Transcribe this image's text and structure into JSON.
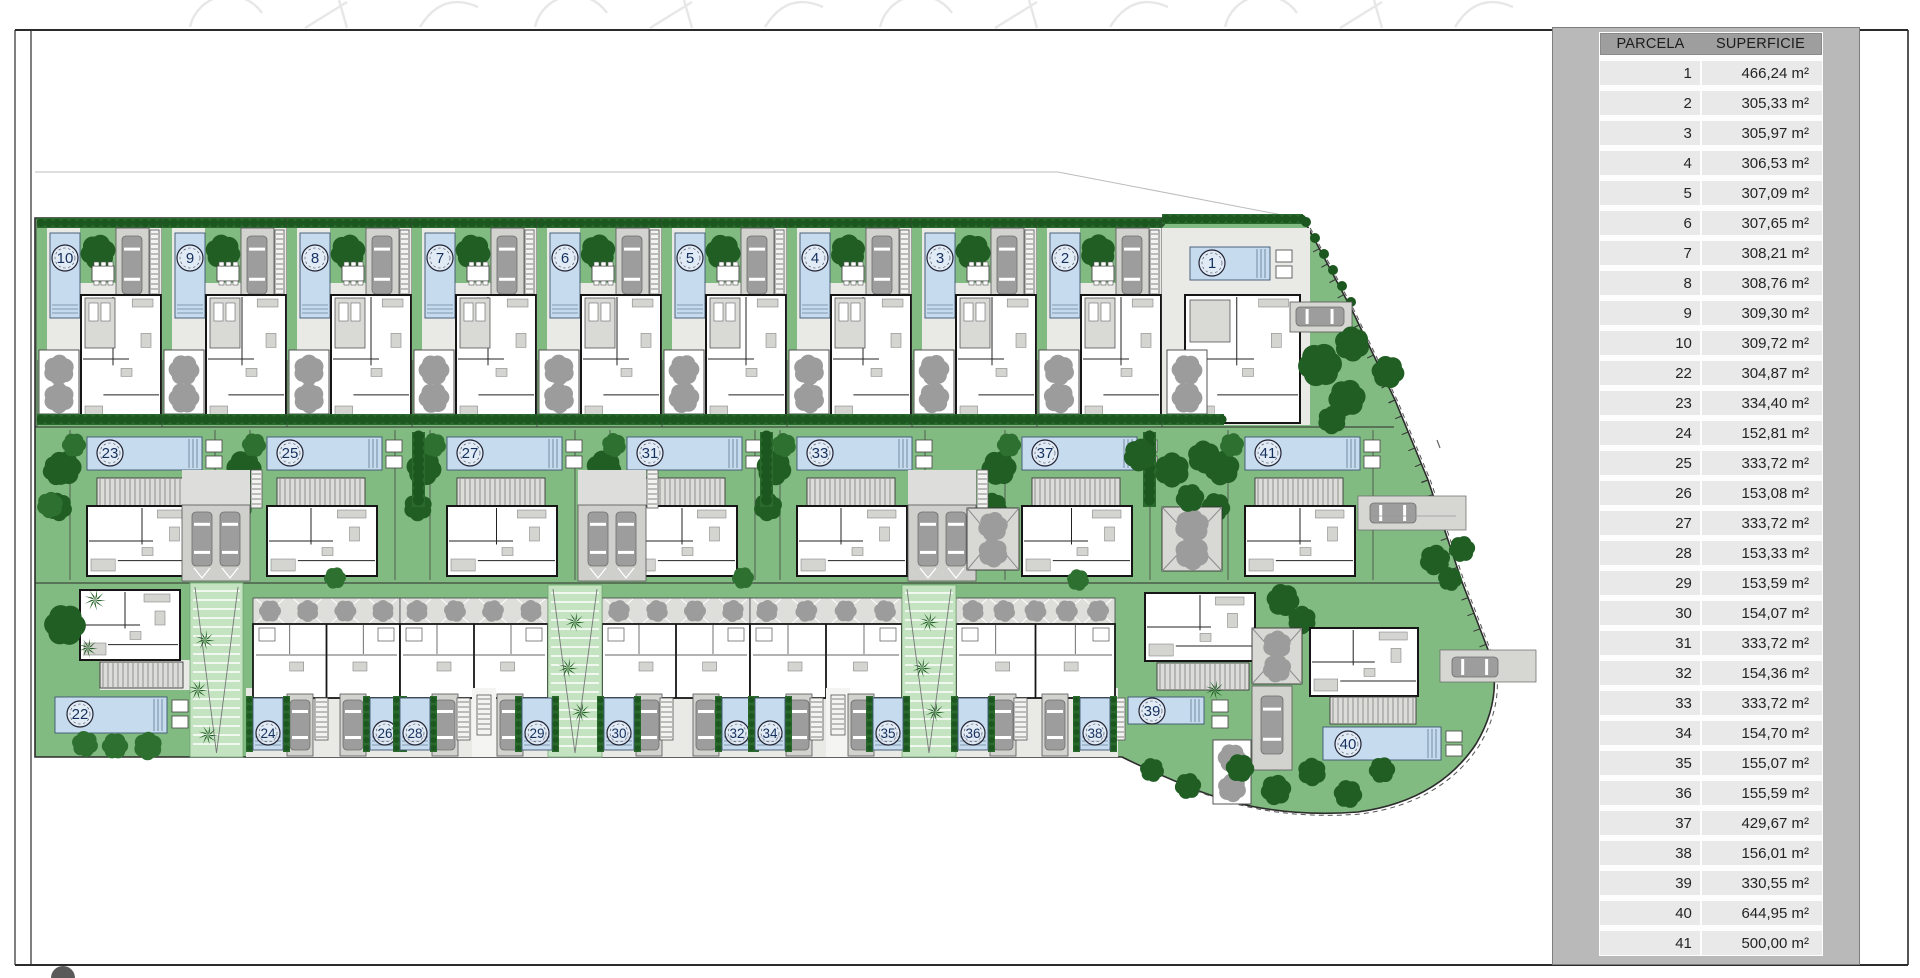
{
  "panel": {
    "col1": "PARCELA",
    "col2": "SUPERFICIE",
    "unit": "m²",
    "rows": [
      {
        "parcela": "1",
        "superficie": "466,24"
      },
      {
        "parcela": "2",
        "superficie": "305,33"
      },
      {
        "parcela": "3",
        "superficie": "305,97"
      },
      {
        "parcela": "4",
        "superficie": "306,53"
      },
      {
        "parcela": "5",
        "superficie": "307,09"
      },
      {
        "parcela": "6",
        "superficie": "307,65"
      },
      {
        "parcela": "7",
        "superficie": "308,21"
      },
      {
        "parcela": "8",
        "superficie": "308,76"
      },
      {
        "parcela": "9",
        "superficie": "309,30"
      },
      {
        "parcela": "10",
        "superficie": "309,72"
      },
      {
        "parcela": "22",
        "superficie": "304,87"
      },
      {
        "parcela": "23",
        "superficie": "334,40"
      },
      {
        "parcela": "24",
        "superficie": "152,81"
      },
      {
        "parcela": "25",
        "superficie": "333,72"
      },
      {
        "parcela": "26",
        "superficie": "153,08"
      },
      {
        "parcela": "27",
        "superficie": "333,72"
      },
      {
        "parcela": "28",
        "superficie": "153,33"
      },
      {
        "parcela": "29",
        "superficie": "153,59"
      },
      {
        "parcela": "30",
        "superficie": "154,07"
      },
      {
        "parcela": "31",
        "superficie": "333,72"
      },
      {
        "parcela": "32",
        "superficie": "154,36"
      },
      {
        "parcela": "33",
        "superficie": "333,72"
      },
      {
        "parcela": "34",
        "superficie": "154,70"
      },
      {
        "parcela": "35",
        "superficie": "155,07"
      },
      {
        "parcela": "36",
        "superficie": "155,59"
      },
      {
        "parcela": "37",
        "superficie": "429,67"
      },
      {
        "parcela": "38",
        "superficie": "156,01"
      },
      {
        "parcela": "39",
        "superficie": "330,55"
      },
      {
        "parcela": "40",
        "superficie": "644,95"
      },
      {
        "parcela": "41",
        "superficie": "500,00"
      }
    ]
  },
  "site": {
    "top_plots": [
      {
        "number": "10",
        "left": 37
      },
      {
        "number": "9",
        "left": 162
      },
      {
        "number": "8",
        "left": 287
      },
      {
        "number": "7",
        "left": 412
      },
      {
        "number": "6",
        "left": 537
      },
      {
        "number": "5",
        "left": 662
      },
      {
        "number": "4",
        "left": 787
      },
      {
        "number": "3",
        "left": 912
      },
      {
        "number": "2",
        "left": 1037
      }
    ],
    "plot1": {
      "number": "1"
    },
    "middle_plots": [
      {
        "number": "23",
        "left": 70
      },
      {
        "number": "25",
        "left": 250
      },
      {
        "number": "27",
        "left": 430
      },
      {
        "number": "31",
        "left": 610
      },
      {
        "number": "33",
        "left": 780
      },
      {
        "number": "37",
        "left": 1005
      },
      {
        "number": "41",
        "left": 1228
      }
    ],
    "bottom_pools": [
      {
        "number": "24",
        "x": 253
      },
      {
        "number": "26",
        "x": 370
      },
      {
        "number": "28",
        "x": 400
      },
      {
        "number": "29",
        "x": 522
      },
      {
        "number": "30",
        "x": 604
      },
      {
        "number": "32",
        "x": 722
      },
      {
        "number": "34",
        "x": 755
      },
      {
        "number": "35",
        "x": 873
      },
      {
        "number": "36",
        "x": 958
      },
      {
        "number": "38",
        "x": 1080
      }
    ],
    "plot22": {
      "number": "22"
    },
    "plot39": {
      "number": "39"
    },
    "plot40": {
      "number": "40"
    }
  },
  "colors": {
    "green": "#82bb82",
    "walk_green": "#c3e3c1",
    "pool_blue": "#c6dbed",
    "ground": "#e9e9e6",
    "carport": "#d2d2cf",
    "car": "#9d9d9d",
    "gray_tree": "#9c9c9c",
    "dark_green": "#205e23",
    "dark_green2": "#2e7030",
    "hedge": "#1d5720",
    "wall": "#161616",
    "frame": "#2b2b2b",
    "num_text": "#16305e",
    "panel_gray": "#b9b9b9"
  }
}
